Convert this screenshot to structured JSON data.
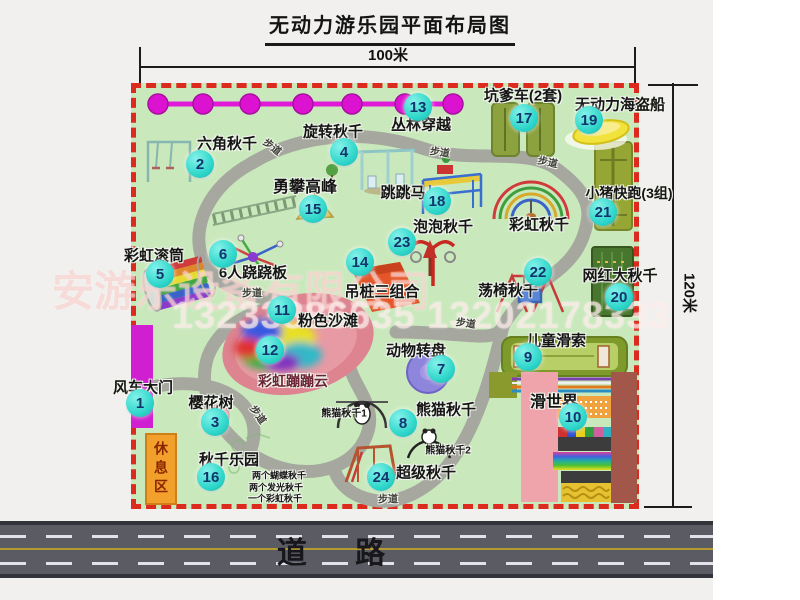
{
  "title": "无动力游乐园平面布局图",
  "dimensions": {
    "width_label": "100米",
    "height_label": "120米"
  },
  "watermark": {
    "company": "安游乐设备有限公司",
    "phones": "13233886635 13202178333"
  },
  "road": {
    "label": "道 路"
  },
  "rest_area_label": "休息区",
  "map": {
    "markers": [
      {
        "num": "1",
        "x": 140,
        "y": 403
      },
      {
        "num": "2",
        "x": 200,
        "y": 164
      },
      {
        "num": "3",
        "x": 215,
        "y": 422
      },
      {
        "num": "4",
        "x": 344,
        "y": 152
      },
      {
        "num": "5",
        "x": 160,
        "y": 274
      },
      {
        "num": "6",
        "x": 223,
        "y": 254
      },
      {
        "num": "7",
        "x": 441,
        "y": 369
      },
      {
        "num": "8",
        "x": 403,
        "y": 423
      },
      {
        "num": "9",
        "x": 528,
        "y": 357
      },
      {
        "num": "10",
        "x": 573,
        "y": 417
      },
      {
        "num": "11",
        "x": 282,
        "y": 310
      },
      {
        "num": "12",
        "x": 270,
        "y": 350
      },
      {
        "num": "13",
        "x": 418,
        "y": 107
      },
      {
        "num": "14",
        "x": 360,
        "y": 262
      },
      {
        "num": "15",
        "x": 313,
        "y": 209
      },
      {
        "num": "16",
        "x": 211,
        "y": 477
      },
      {
        "num": "17",
        "x": 524,
        "y": 118
      },
      {
        "num": "18",
        "x": 437,
        "y": 201
      },
      {
        "num": "19",
        "x": 589,
        "y": 120
      },
      {
        "num": "20",
        "x": 619,
        "y": 297
      },
      {
        "num": "21",
        "x": 603,
        "y": 212
      },
      {
        "num": "22",
        "x": 538,
        "y": 272
      },
      {
        "num": "23",
        "x": 402,
        "y": 242
      },
      {
        "num": "24",
        "x": 381,
        "y": 477
      }
    ],
    "labels": [
      {
        "text": "六角秋千",
        "x": 227,
        "y": 143,
        "size": 15
      },
      {
        "text": "旋转秋千",
        "x": 333,
        "y": 131,
        "size": 15
      },
      {
        "text": "丛林穿越",
        "x": 421,
        "y": 124,
        "size": 15
      },
      {
        "text": "坑爹车(2套)",
        "x": 523,
        "y": 95,
        "size": 15
      },
      {
        "text": "无动力海盗船",
        "x": 620,
        "y": 104,
        "size": 15
      },
      {
        "text": "勇攀高峰",
        "x": 305,
        "y": 185,
        "size": 16
      },
      {
        "text": "小猪快跑(3组)",
        "x": 629,
        "y": 193,
        "size": 14
      },
      {
        "text": "跳跳马",
        "x": 403,
        "y": 192,
        "size": 15
      },
      {
        "text": "彩虹秋千",
        "x": 539,
        "y": 224,
        "size": 15
      },
      {
        "text": "泡泡秋千",
        "x": 443,
        "y": 226,
        "size": 15
      },
      {
        "text": "彩虹滚筒",
        "x": 154,
        "y": 255,
        "size": 15
      },
      {
        "text": "6人跷跷板",
        "x": 253,
        "y": 272,
        "size": 15
      },
      {
        "text": "吊桩三组合",
        "x": 382,
        "y": 291,
        "size": 15
      },
      {
        "text": "网红大秋千",
        "x": 620,
        "y": 275,
        "size": 15
      },
      {
        "text": "荡椅秋千",
        "x": 508,
        "y": 290,
        "size": 15
      },
      {
        "text": "粉色沙滩",
        "x": 328,
        "y": 320,
        "size": 15
      },
      {
        "text": "动物转盘",
        "x": 416,
        "y": 350,
        "size": 15
      },
      {
        "text": "儿童滑索",
        "x": 556,
        "y": 340,
        "size": 15
      },
      {
        "text": "风车大门",
        "x": 143,
        "y": 387,
        "size": 15
      },
      {
        "text": "樱花树",
        "x": 211,
        "y": 402,
        "size": 15
      },
      {
        "text": "彩虹蹦蹦云",
        "x": 293,
        "y": 381,
        "size": 14,
        "color": "#6b2433"
      },
      {
        "text": "熊猫秋千",
        "x": 446,
        "y": 409,
        "size": 15
      },
      {
        "text": "熊猫秋千1",
        "x": 344,
        "y": 412,
        "size": 10
      },
      {
        "text": "熊猫秋千2",
        "x": 448,
        "y": 449,
        "size": 10
      },
      {
        "text": "滑世界",
        "x": 554,
        "y": 400,
        "size": 16
      },
      {
        "text": "秋千乐园",
        "x": 229,
        "y": 459,
        "size": 15
      },
      {
        "text": "超级秋千",
        "x": 426,
        "y": 472,
        "size": 15
      },
      {
        "text": "两个蝴蝶秋千",
        "x": 279,
        "y": 475,
        "size": 9
      },
      {
        "text": "两个发光秋千",
        "x": 276,
        "y": 487,
        "size": 9
      },
      {
        "text": "一个彩虹秋千",
        "x": 275,
        "y": 498,
        "size": 9
      }
    ],
    "path_labels": [
      {
        "text": "步道",
        "x": 273,
        "y": 146,
        "size": 10,
        "rotate": 38
      },
      {
        "text": "步道",
        "x": 440,
        "y": 151,
        "size": 10,
        "rotate": 8
      },
      {
        "text": "步道",
        "x": 548,
        "y": 161,
        "size": 10,
        "rotate": 12
      },
      {
        "text": "步道",
        "x": 252,
        "y": 292,
        "size": 10,
        "rotate": 0
      },
      {
        "text": "步道",
        "x": 466,
        "y": 322,
        "size": 10,
        "rotate": 8
      },
      {
        "text": "步道",
        "x": 259,
        "y": 414,
        "size": 10,
        "rotate": 55
      },
      {
        "text": "步道",
        "x": 388,
        "y": 498,
        "size": 10,
        "rotate": 0
      }
    ]
  }
}
